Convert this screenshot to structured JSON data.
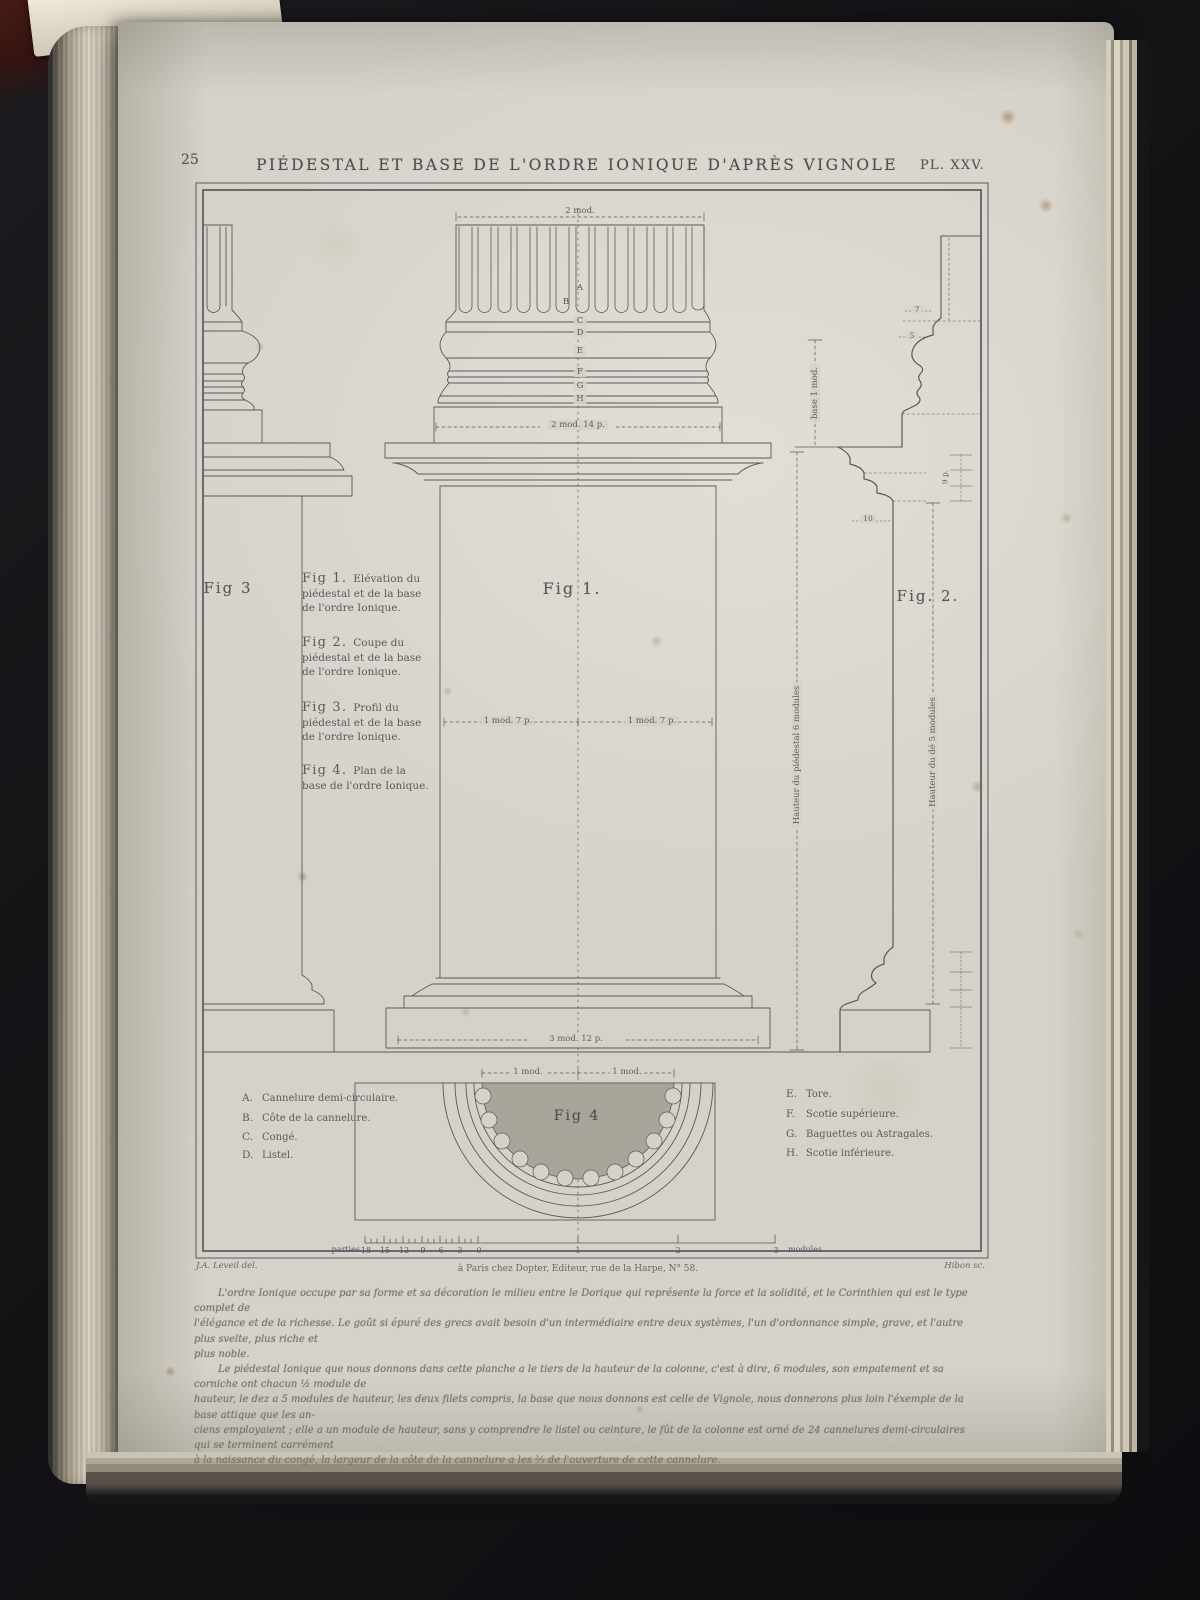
{
  "colors": {
    "paper": "#d5d2c9",
    "ink": "#56545c",
    "shade": "#a8a59b",
    "background": "#141417"
  },
  "header": {
    "page_number": "25",
    "title": "PIÉDESTAL ET BASE DE L'ORDRE IONIQUE D'APRÈS VIGNOLE",
    "plate": "PL. XXV."
  },
  "figures": {
    "fig1": "Fig 1.",
    "fig2": "Fig. 2.",
    "fig3": "Fig 3",
    "fig4": "Fig 4"
  },
  "captions": [
    {
      "fig": "Fig 1.",
      "lines": [
        "Elévation du",
        "piédestal et de la base",
        "de l'ordre Ionique."
      ]
    },
    {
      "fig": "Fig 2.",
      "lines": [
        "Coupe du",
        "piédestal et de la base",
        "de l'ordre Ionique."
      ]
    },
    {
      "fig": "Fig 3.",
      "lines": [
        "Profil du",
        "piédestal et de la base",
        "de l'ordre Ionique."
      ]
    },
    {
      "fig": "Fig 4.",
      "lines": [
        "Plan de la",
        "base de l'ordre Ionique."
      ]
    }
  ],
  "legend_left": [
    {
      "key": "A.",
      "label": "Cannelure demi-circulaire."
    },
    {
      "key": "B.",
      "label": "Côte de la cannelure."
    },
    {
      "key": "C.",
      "label": "Congé."
    },
    {
      "key": "D.",
      "label": "Listel."
    }
  ],
  "legend_right": [
    {
      "key": "E.",
      "label": "Tore."
    },
    {
      "key": "F.",
      "label": "Scotie supérieure."
    },
    {
      "key": "G.",
      "label": "Baguettes ou Astragales."
    },
    {
      "key": "H.",
      "label": "Scotie inférieure."
    }
  ],
  "parts": [
    "A",
    "B",
    "C",
    "D",
    "E",
    "F",
    "G",
    "H"
  ],
  "dims": {
    "top": "2 mod.",
    "base_block": "2 mod. 14 p.",
    "die_left": "1 mod. 7 p.",
    "die_right": "1 mod. 7 p.",
    "bottom": "3 mod. 12 p.",
    "base_height": "base 1 mod.",
    "pedestal_height": "Hauteur du piédestal 6 modules",
    "die_height": "Hauteur du dé 5 modules",
    "fig4_left": "1 mod.",
    "fig4_right": "1 mod.",
    "n7": "7",
    "n5": "5",
    "n10": "10",
    "n9p": "9 p."
  },
  "scale": {
    "caption_left": "parties",
    "parts": [
      "18",
      "15",
      "12",
      "9",
      "6",
      "3",
      "0"
    ],
    "modules": [
      "1",
      "2",
      "3"
    ],
    "unit": "modules"
  },
  "imprint": {
    "left": "J.A. Leveil del.",
    "center": "à Paris chez Dopter, Editeur, rue de la Harpe, N° 58.",
    "right": "Hibon sc."
  },
  "text": {
    "para1": [
      "L'ordre Ionique occupe par sa forme et sa décoration le milieu entre le Dorique qui représente la force et la solidité, et le Corinthien qui est le type complet de",
      "l'élégance et de la richesse. Le goût si épuré des grecs avait besoin d'un intermédiaire entre deux systèmes, l'un d'ordonnance simple, grave, et l'autre plus svelte, plus riche et",
      "plus noble."
    ],
    "para2": [
      "Le piédestal Ionique que nous donnons dans cette planche a le tiers de la hauteur de la colonne, c'est à dire, 6 modules, son empatement et sa corniche ont chacun ½ module de",
      "hauteur, le dez a 5 modules de hauteur, les deux filets compris, la base que nous donnons est celle de Vignole, nous donnerons plus loin l'éxemple de la base attique que les an-",
      "ciens employaient ; elle a un module de hauteur, sans y comprendre le listel ou ceinture, le fût de la colonne est orné de 24 cannelures demi-circulaires qui se terminent carrément",
      "à la naissance du congé, la largeur de la côte de la cannelure a les ⅖ de l'ouverture de cette cannelure."
    ]
  }
}
